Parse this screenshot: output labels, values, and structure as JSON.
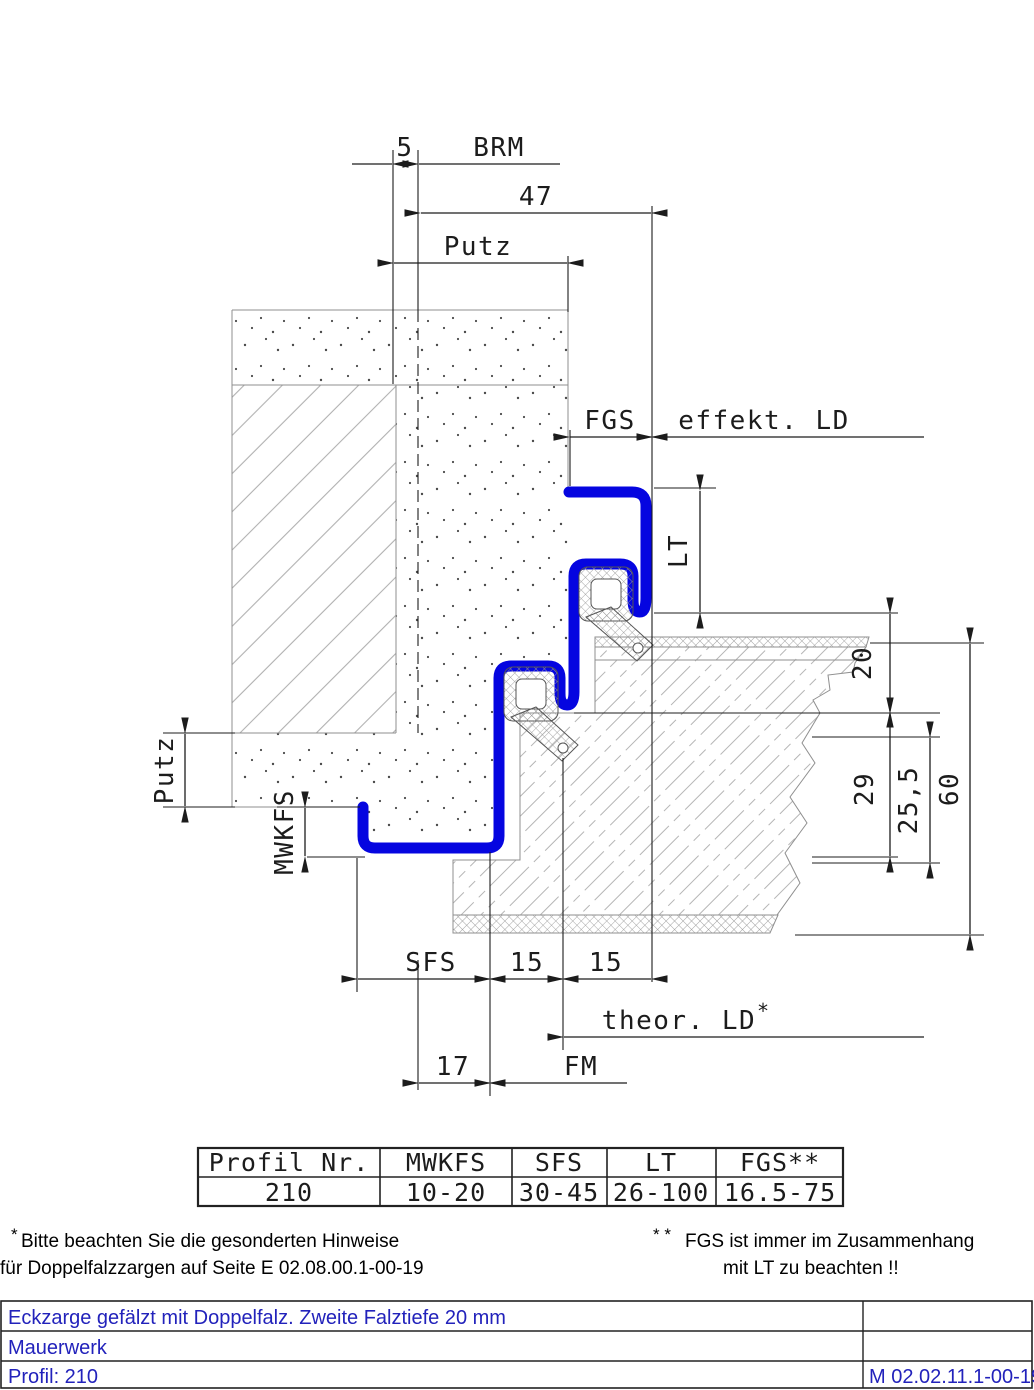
{
  "dims": {
    "d5": "5",
    "brm": "BRM",
    "d47": "47",
    "putz_top": "Putz",
    "fgs": "FGS",
    "effekt_ld": "effekt. LD",
    "lt": "LT",
    "d20": "20",
    "d29": "29",
    "d25_5": "25,5",
    "d60": "60",
    "putz_left": "Putz",
    "mwkfs": "MWKFS",
    "sfs": "SFS",
    "d15a": "15",
    "d15b": "15",
    "theor_ld": "theor. LD",
    "theor_star": "*",
    "d17": "17",
    "fm": "FM"
  },
  "table": {
    "headers": [
      "Profil Nr.",
      "MWKFS",
      "SFS",
      "LT",
      "FGS**"
    ],
    "row": [
      "210",
      "10-20",
      "30-45",
      "26-100",
      "16.5-75"
    ]
  },
  "footnotes": {
    "left_star": "*",
    "left1": "Bitte beachten Sie die gesonderten Hinweise",
    "left2": "für Doppelfalzzargen auf Seite E 02.08.00.1-00-19",
    "right_stars": "* *",
    "right1": "FGS ist immer im Zusammenhang",
    "right2": "mit LT zu beachten !!"
  },
  "titleblock": {
    "row1": "Eckzarge gefälzt mit Doppelfalz. Zweite Falztiefe 20 mm",
    "row2": "Mauerwerk",
    "row3": "Profil: 210",
    "doc_number": "M 02.02.11.1-00-19"
  },
  "colors": {
    "frame_blue": "#0505e0",
    "title_blue": "#2222bb"
  }
}
